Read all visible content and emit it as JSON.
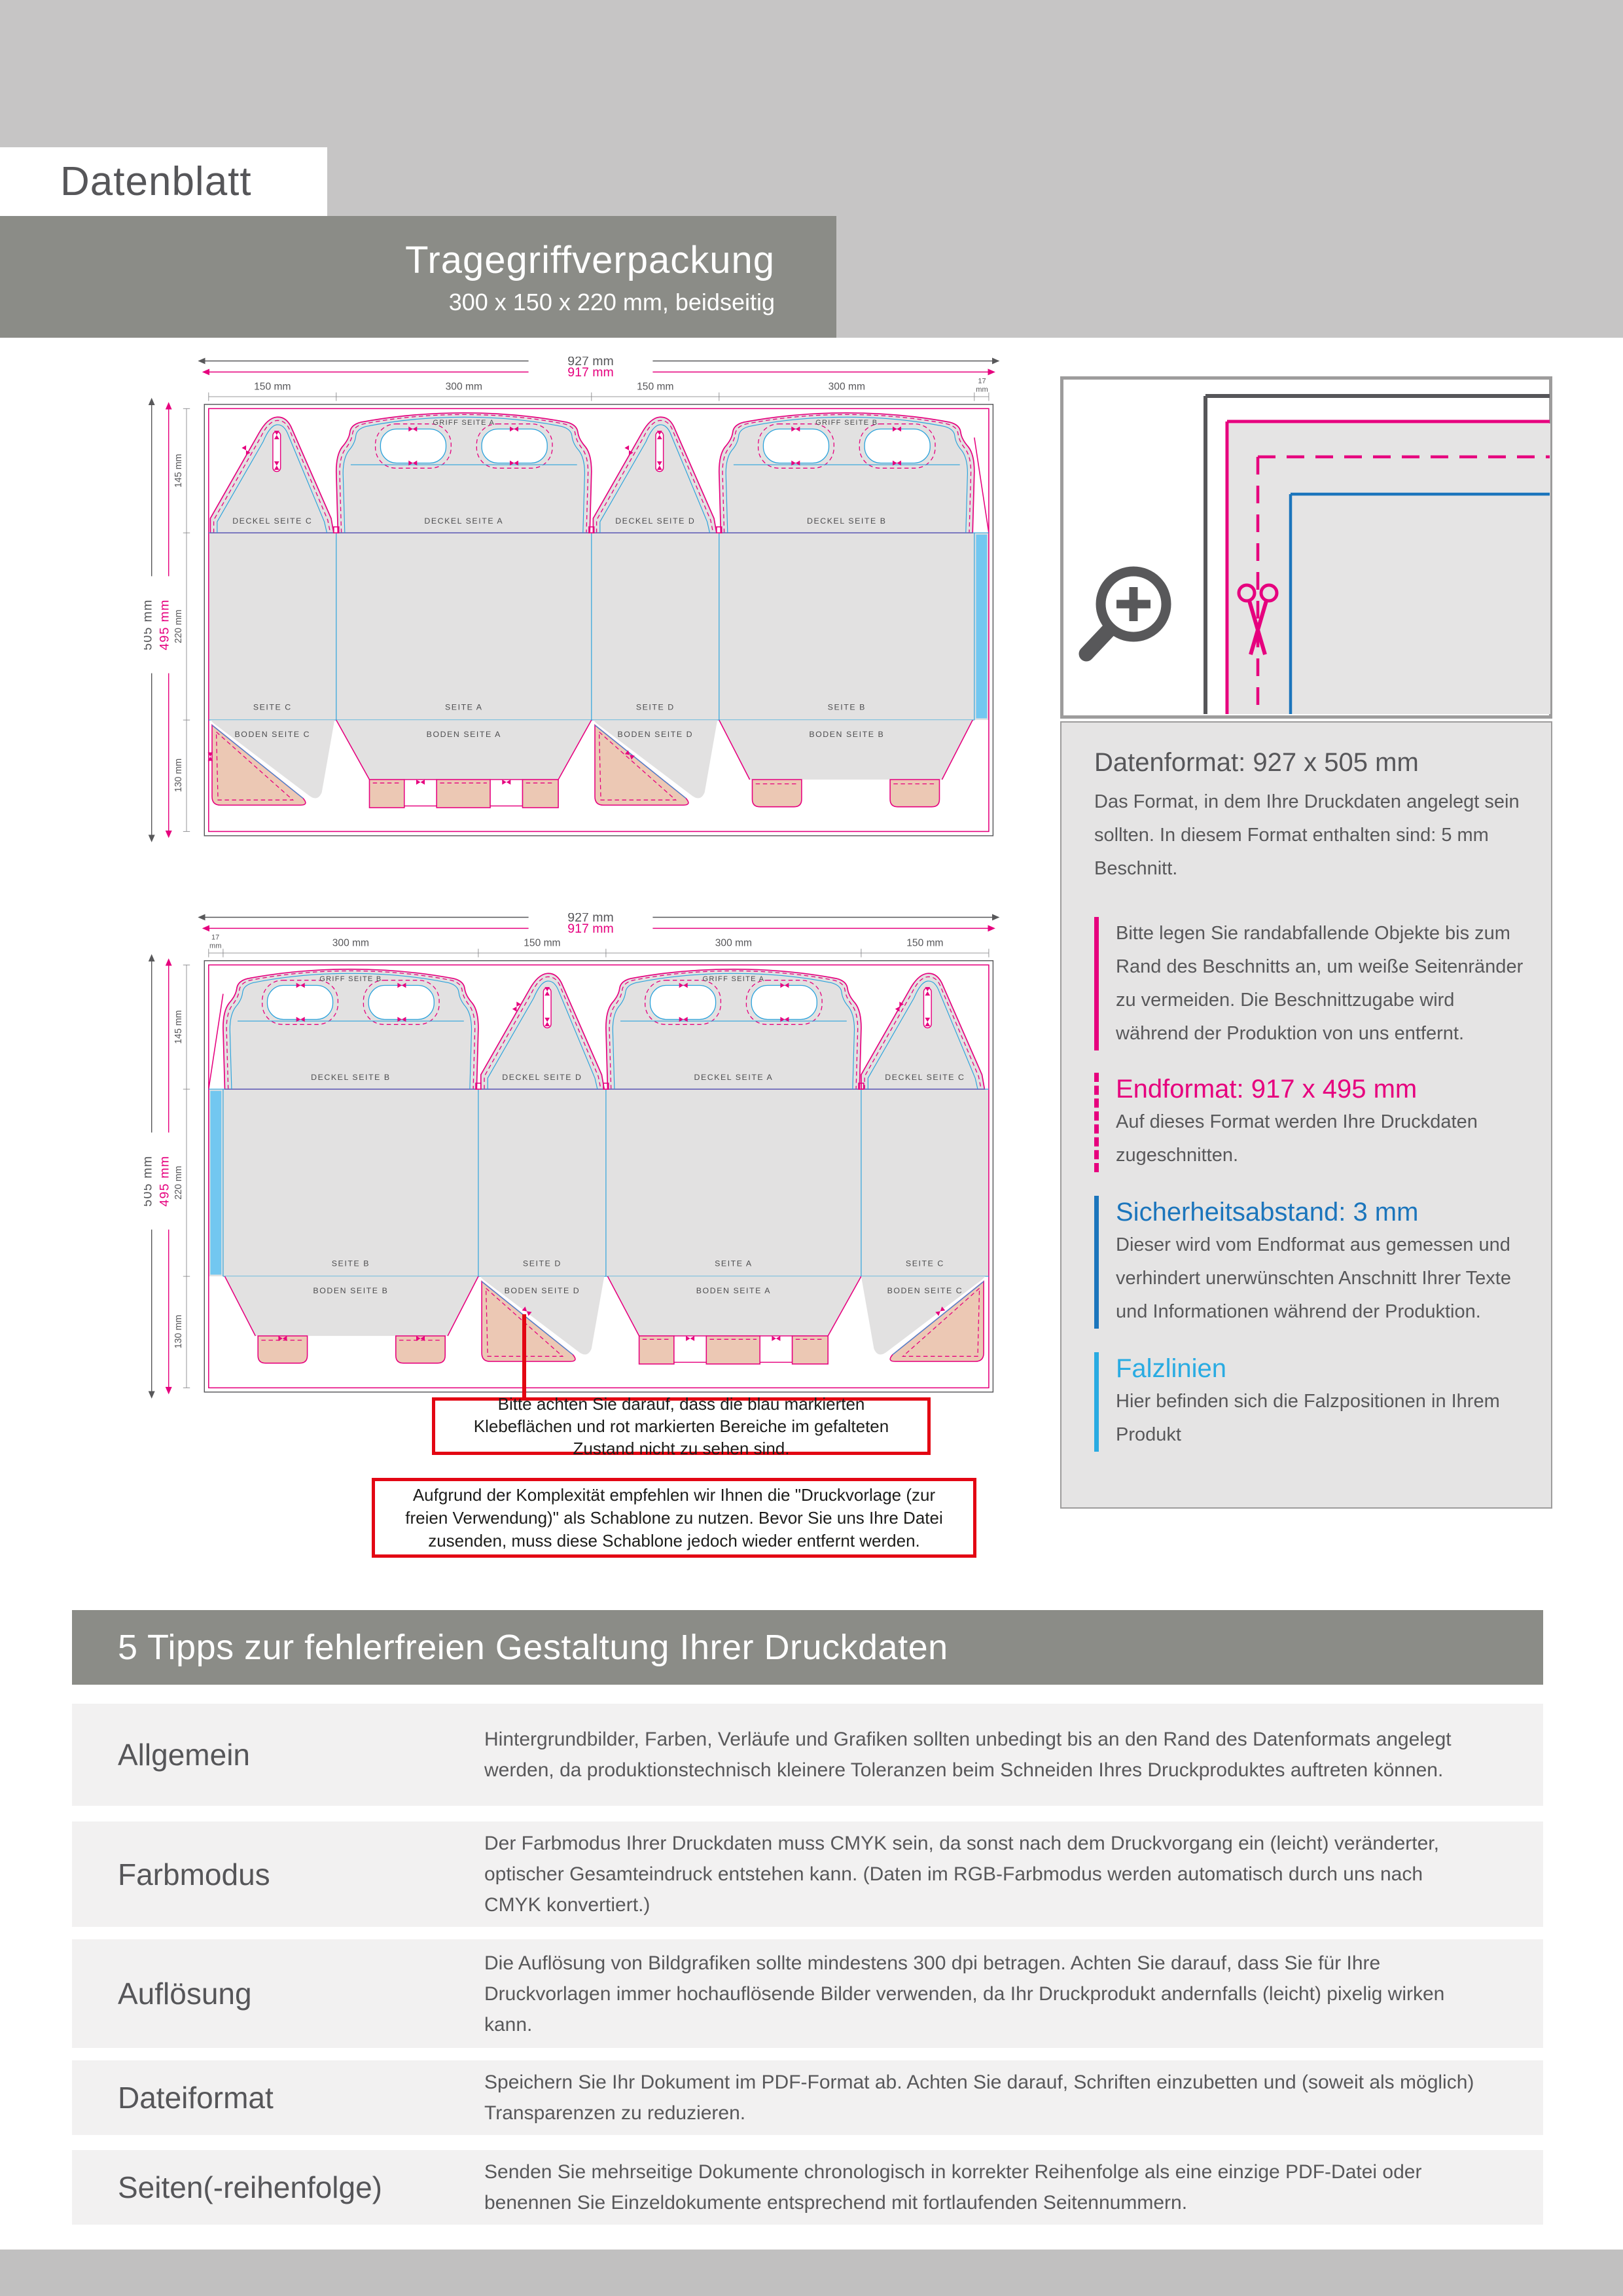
{
  "header": {
    "doc_label": "Datenblatt",
    "title": "Tragegriffverpackung",
    "subtitle": "300 x 150 x 220 mm, beidseitig"
  },
  "drawing1": {
    "dim_outer_w": "927 mm",
    "dim_inner_w": "917 mm",
    "col_dims": [
      "150 mm",
      "300 mm",
      "150 mm",
      "300 mm"
    ],
    "dim17": [
      "17",
      "mm"
    ],
    "dim_outer_h": "505 mm",
    "dim_inner_h": "495 mm",
    "row_dims": [
      "145 mm",
      "220 mm",
      "130 mm"
    ],
    "griff_a": "GRIFF SEITE A",
    "griff_b": "GRIFF SEITE B",
    "deckel": [
      "DECKEL SEITE C",
      "DECKEL SEITE A",
      "DECKEL SEITE D",
      "DECKEL SEITE B"
    ],
    "seite": [
      "SEITE C",
      "SEITE A",
      "SEITE D",
      "SEITE B"
    ],
    "boden": [
      "BODEN SEITE C",
      "BODEN SEITE A",
      "BODEN SEITE D",
      "BODEN SEITE B"
    ]
  },
  "drawing2": {
    "dim_outer_w": "927 mm",
    "dim_inner_w": "917 mm",
    "col_dims": [
      "300 mm",
      "150 mm",
      "300 mm",
      "150 mm"
    ],
    "dim17": [
      "17",
      "mm"
    ],
    "dim_outer_h": "505 mm",
    "dim_inner_h": "495 mm",
    "row_dims": [
      "145 mm",
      "220 mm",
      "130 mm"
    ],
    "griff_a": "GRIFF SEITE A",
    "griff_b": "GRIFF SEITE B",
    "deckel": [
      "DECKEL SEITE B",
      "DECKEL SEITE D",
      "DECKEL SEITE A",
      "DECKEL SEITE C"
    ],
    "seite": [
      "SEITE B",
      "SEITE D",
      "SEITE A",
      "SEITE C"
    ],
    "boden": [
      "BODEN SEITE B",
      "BODEN SEITE D",
      "BODEN SEITE A",
      "BODEN SEITE C"
    ]
  },
  "info": {
    "datenformat_title": "Datenformat: 927 x 505 mm",
    "datenformat_text": "Das Format, in dem Ihre Druckdaten angelegt sein sollten. In diesem Format enthalten sind: 5 mm Beschnitt.",
    "bleed_text": "Bitte legen Sie randabfallende Objekte bis zum Rand des Beschnitts an, um weiße Seitenränder zu vermeiden. Die Beschnitt­zugabe wird während der Produktion von uns entfernt.",
    "endformat_title": "Endformat: 917 x 495 mm",
    "endformat_text": "Auf dieses Format werden Ihre Druckdaten zugeschnitten.",
    "sicherheit_title": "Sicherheitsabstand: 3 mm",
    "sicherheit_text": "Dieser wird vom Endformat aus gemessen und verhindert unerwünschten Anschnitt Ihrer Texte und Informationen während der Produktion.",
    "falz_title": "Falzlinien",
    "falz_text": "Hier befinden sich die Falzpositionen in Ihrem Produkt"
  },
  "notes": {
    "note1": "Bitte achten Sie darauf, dass die blau markierten Klebeflächen und rot markierten Bereiche im gefalteten Zustand nicht zu sehen sind.",
    "note2": "Aufgrund der Komplexität empfehlen wir Ihnen die \"Druckvorlage (zur freien Verwendung)\" als Schablone zu nutzen. Bevor Sie uns Ihre Datei zusenden, muss diese Schablone jedoch wieder entfernt werden."
  },
  "tips": {
    "header": "5 Tipps zur fehlerfreien Gestaltung Ihrer Druckdaten",
    "rows": [
      {
        "label": "Allgemein",
        "text": "Hintergrundbilder, Farben, Verläufe und Grafiken sollten unbedingt bis an den Rand des Datenformats angelegt werden, da produktionstechnisch kleinere Toleranzen beim Schneiden Ihres Druckproduktes auftreten können."
      },
      {
        "label": "Farbmodus",
        "text": "Der Farbmodus Ihrer Druckdaten muss CMYK sein, da sonst nach dem Druckvorgang ein (leicht) veränderter, optischer Gesamteindruck entstehen kann. (Daten im RGB-Farbmodus werden automatisch durch uns nach CMYK konvertiert.)"
      },
      {
        "label": "Auflösung",
        "text": "Die Auflösung von Bildgrafiken sollte mindestens 300 dpi betragen. Achten Sie darauf, dass Sie für Ihre Druckvorlagen immer hochauflösende Bilder verwenden, da Ihr Druckprodukt andernfalls (leicht) pixelig wirken kann."
      },
      {
        "label": "Dateiformat",
        "text": "Speichern Sie Ihr Dokument im PDF-Format ab. Achten Sie darauf, Schriften einzubetten und (soweit als möglich) Transparenzen zu reduzieren."
      },
      {
        "label": "Seiten(-reihenfolge)",
        "text": "Senden Sie mehrseitige Dokumente chronologisch in korrekter Reihenfolge als eine einzige PDF-Datei oder benennen Sie Einzeldokumente entsprechend mit fortlaufenden Seitennummern."
      }
    ]
  },
  "colors": {
    "cut_magenta": "#e6007e",
    "fold_blue": "#2aa3dc",
    "safety_blue": "#1b75bc",
    "falz_cyan": "#29abe2",
    "glue_salmon": "#ecc8b4",
    "glue_stripe": "#72c7f0",
    "band_gray": "#8b8c87",
    "alert_red": "#e30613"
  }
}
